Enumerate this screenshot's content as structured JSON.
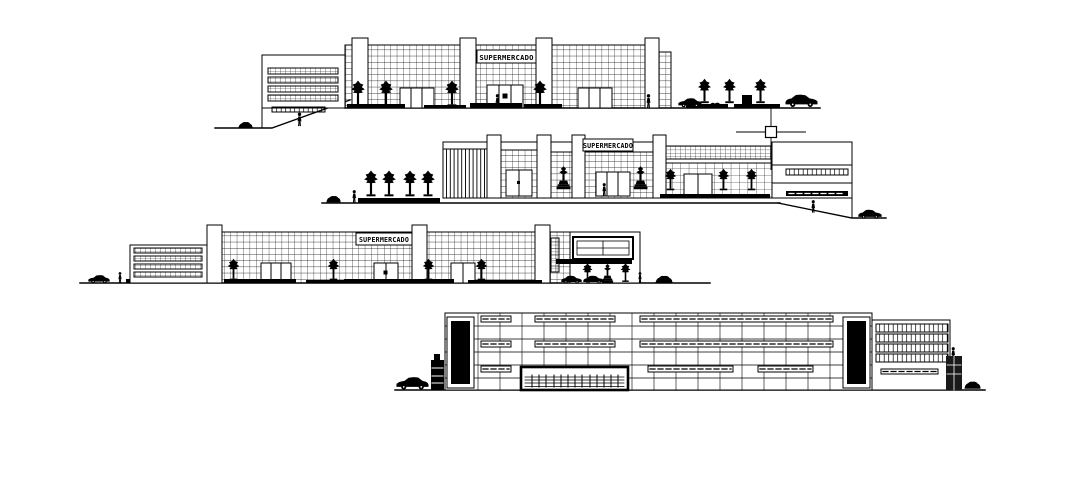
{
  "canvas": {
    "background_color": "#ffffff",
    "ink_color": "#000000"
  },
  "drawing": {
    "elevations": [
      {
        "name": "elevation-1",
        "sign": "SUPERMERCADO"
      },
      {
        "name": "elevation-2",
        "sign": "SUPERMERCADO"
      },
      {
        "name": "elevation-3",
        "sign": "SUPERMERCADO"
      },
      {
        "name": "elevation-4"
      }
    ],
    "cursor": {
      "x": 771,
      "y": 132
    }
  }
}
